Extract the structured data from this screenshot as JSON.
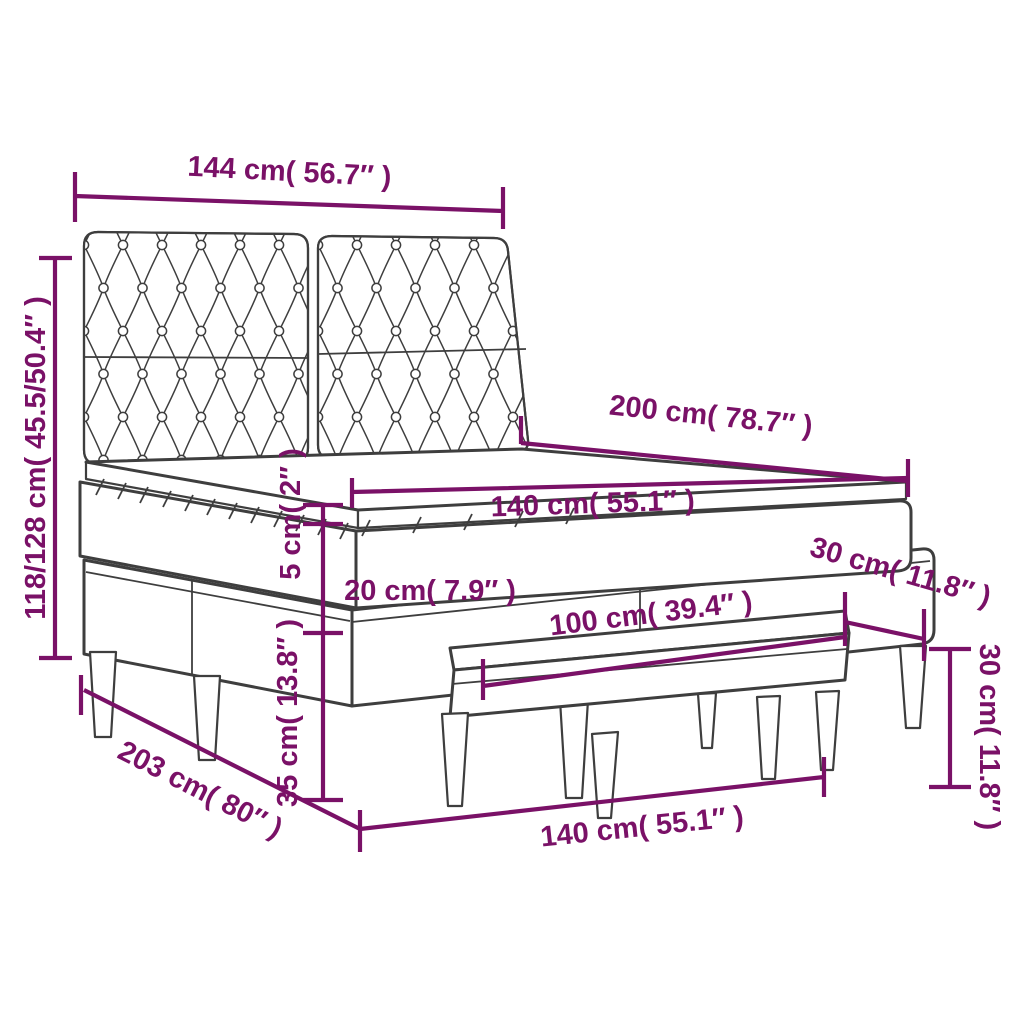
{
  "page": {
    "background": "#FFFFFF"
  },
  "style": {
    "accent_color": "#7A1167",
    "line_color": "#3E3E3E"
  },
  "diagram": {
    "kind": "furniture-dimension-diagram",
    "subject": "box spring bed with tufted headboard, mattress topper and bench",
    "dimensions": {
      "headboard_width": {
        "cm": "144",
        "inches": "56.7",
        "label": "144 cm( 56.7″ )"
      },
      "overall_height": {
        "cm": "118/128",
        "inches": "45.5/50.4",
        "label": "118/128 cm( 45.5/50.4″ )"
      },
      "mattress_length": {
        "cm": "200",
        "inches": "78.7",
        "label": "200 cm( 78.7″ )"
      },
      "mattress_width": {
        "cm": "140",
        "inches": "55.1",
        "label": "140 cm( 55.1″ )"
      },
      "topper_height": {
        "cm": "5",
        "inches": "2",
        "label": "5 cm( 2″ )"
      },
      "mattress_height": {
        "cm": "20",
        "inches": "7.9",
        "label": "20 cm( 7.9″ )"
      },
      "corner_width": {
        "cm": "30",
        "inches": "11.8",
        "label": "30 cm( 11.8″ )"
      },
      "base_height": {
        "cm": "35",
        "inches": "13.8",
        "label": "35 cm( 13.8″ )"
      },
      "bench_length": {
        "cm": "100",
        "inches": "39.4",
        "label": "100 cm( 39.4″ )"
      },
      "bench_height": {
        "cm": "30",
        "inches": "11.8",
        "label": "30 cm( 11.8″ )"
      },
      "frame_length": {
        "cm": "203",
        "inches": "80",
        "label": "203 cm( 80″ )"
      },
      "frame_width": {
        "cm": "140",
        "inches": "55.1",
        "label": "140 cm( 55.1″ )"
      }
    }
  }
}
